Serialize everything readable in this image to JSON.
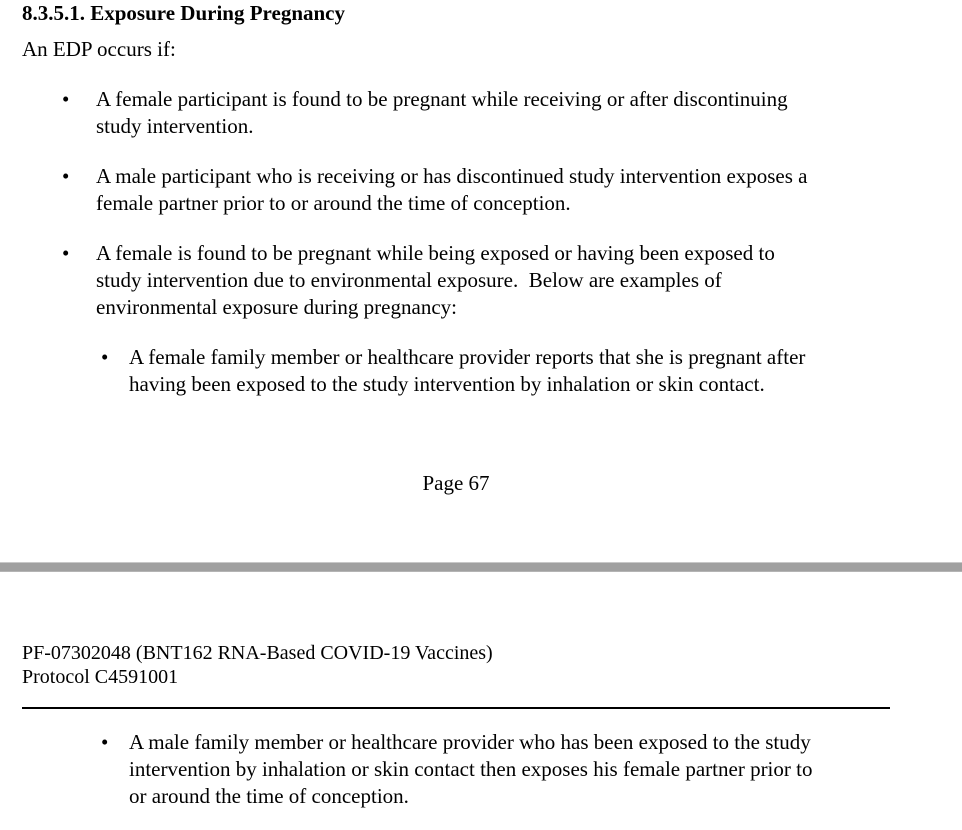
{
  "colors": {
    "page_background": "#ffffff",
    "text": "#000000",
    "page_separator_gray": "#a0a0a0",
    "header_rule_black": "#000000"
  },
  "page_end": {
    "heading": "8.3.5.1. Exposure During Pregnancy",
    "intro": "An EDP occurs if:",
    "bullets": [
      {
        "level": 1,
        "marker": "•",
        "text": "A female participant is found to be pregnant while receiving or after discontinuing\nstudy intervention."
      },
      {
        "level": 1,
        "marker": "•",
        "text": "A male participant who is receiving or has discontinued study intervention exposes a\nfemale partner prior to or around the time of conception."
      },
      {
        "level": 1,
        "marker": "•",
        "text": "A female is found to be pregnant while being exposed or having been exposed to\nstudy intervention due to environmental exposure.  Below are examples of\nenvironmental exposure during pregnancy:"
      },
      {
        "level": 2,
        "marker": "•",
        "text": "A female family member or healthcare provider reports that she is pregnant after\nhaving been exposed to the study intervention by inhalation or skin contact."
      }
    ],
    "page_number": "Page 67"
  },
  "page_next": {
    "running_header": {
      "line1": "PF-07302048 (BNT162 RNA-Based COVID-19 Vaccines)",
      "line2": "Protocol C4591001"
    },
    "bullets": [
      {
        "level": 2,
        "marker": "•",
        "text": "A male family member or healthcare provider who has been exposed to the study\nintervention by inhalation or skin contact then exposes his female partner prior to\nor around the time of conception."
      }
    ]
  }
}
